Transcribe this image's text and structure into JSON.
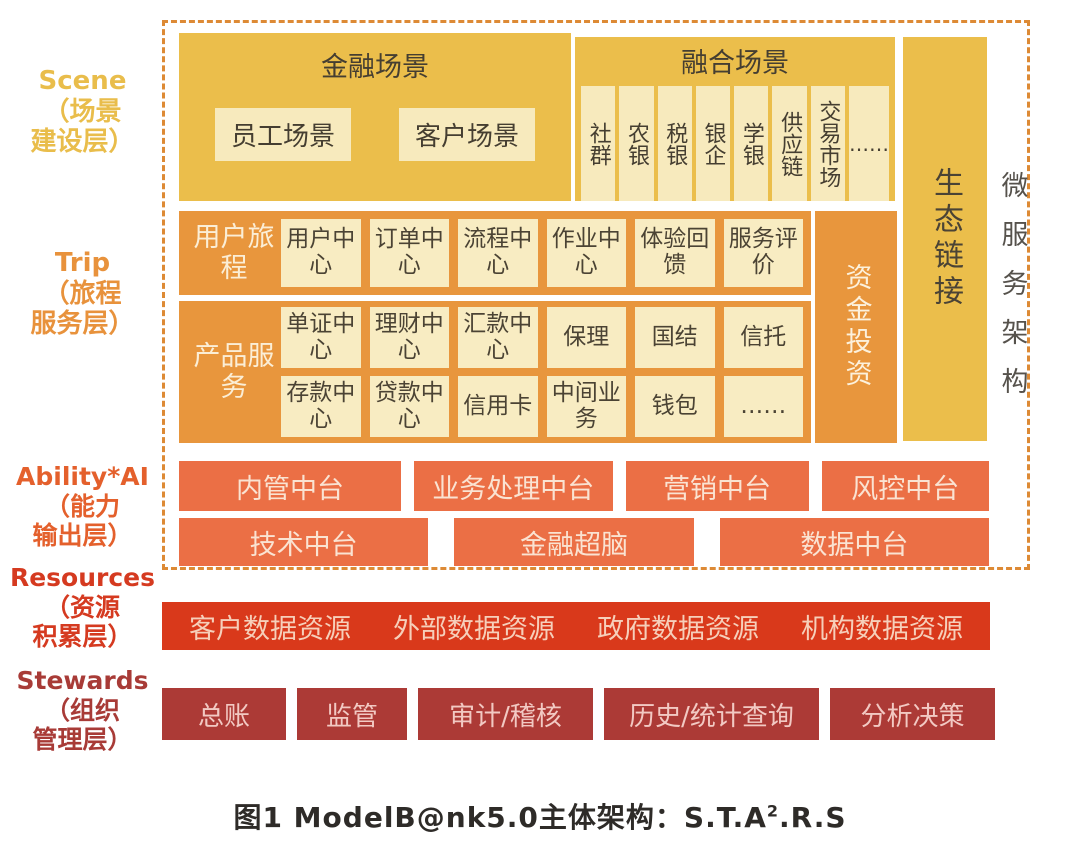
{
  "colors": {
    "scene_yellow": "#EBBE4B",
    "inner_cream": "#F7EABD",
    "trip_orange": "#E8963D",
    "ability_coral": "#EB6F45",
    "resources_red": "#D9391B",
    "stewards_red": "#AC3A36",
    "dashed_border": "#DD8A35"
  },
  "left_labels": {
    "scene": {
      "en": "Scene",
      "zh1": "（场景",
      "zh2": "建设层）"
    },
    "trip": {
      "en": "Trip",
      "zh1": "（旅程",
      "zh2": "服务层）"
    },
    "ability": {
      "en": "Ability*AI",
      "zh1": "（能力",
      "zh2": "输出层）"
    },
    "resources": {
      "en": "Resources",
      "zh1": "（资源",
      "zh2": "积累层）"
    },
    "stewards": {
      "en": "Stewards",
      "zh1": "（组织",
      "zh2": "管理层）"
    }
  },
  "scene": {
    "financial": {
      "title": "金融场景",
      "items": [
        "员工场景",
        "客户场景"
      ]
    },
    "fusion": {
      "title": "融合场景",
      "items": [
        "社群",
        "农银",
        "税银",
        "银企",
        "学银",
        "供应链",
        "交易市场",
        "……"
      ]
    },
    "eco_link": "生态链接",
    "microservice": "微服务架构"
  },
  "trip": {
    "journey_label": "用户旅程",
    "journey_items": [
      "用户中心",
      "订单中心",
      "流程中心",
      "作业中心",
      "体验回馈",
      "服务评价"
    ],
    "product_label": "产品服务",
    "product_row1": [
      "单证中心",
      "理财中心",
      "汇款中心",
      "保理",
      "国结",
      "信托"
    ],
    "product_row2": [
      "存款中心",
      "贷款中心",
      "信用卡",
      "中间业务",
      "钱包",
      "……"
    ],
    "funding": "资金投资"
  },
  "ability": {
    "row1": [
      "内管中台",
      "业务处理中台",
      "营销中台",
      "风控中台"
    ],
    "row2": [
      "技术中台",
      "金融超脑",
      "数据中台"
    ]
  },
  "resources": {
    "items": [
      "客户数据资源",
      "外部数据资源",
      "政府数据资源",
      "机构数据资源"
    ]
  },
  "stewards": {
    "items": [
      "总账",
      "监管",
      "审计/稽核",
      "历史/统计查询",
      "分析决策"
    ]
  },
  "caption": {
    "main": "图1 ModelB@nk5.0主体架构：S.T.A",
    "sup": "2",
    "tail": ".R.S"
  }
}
